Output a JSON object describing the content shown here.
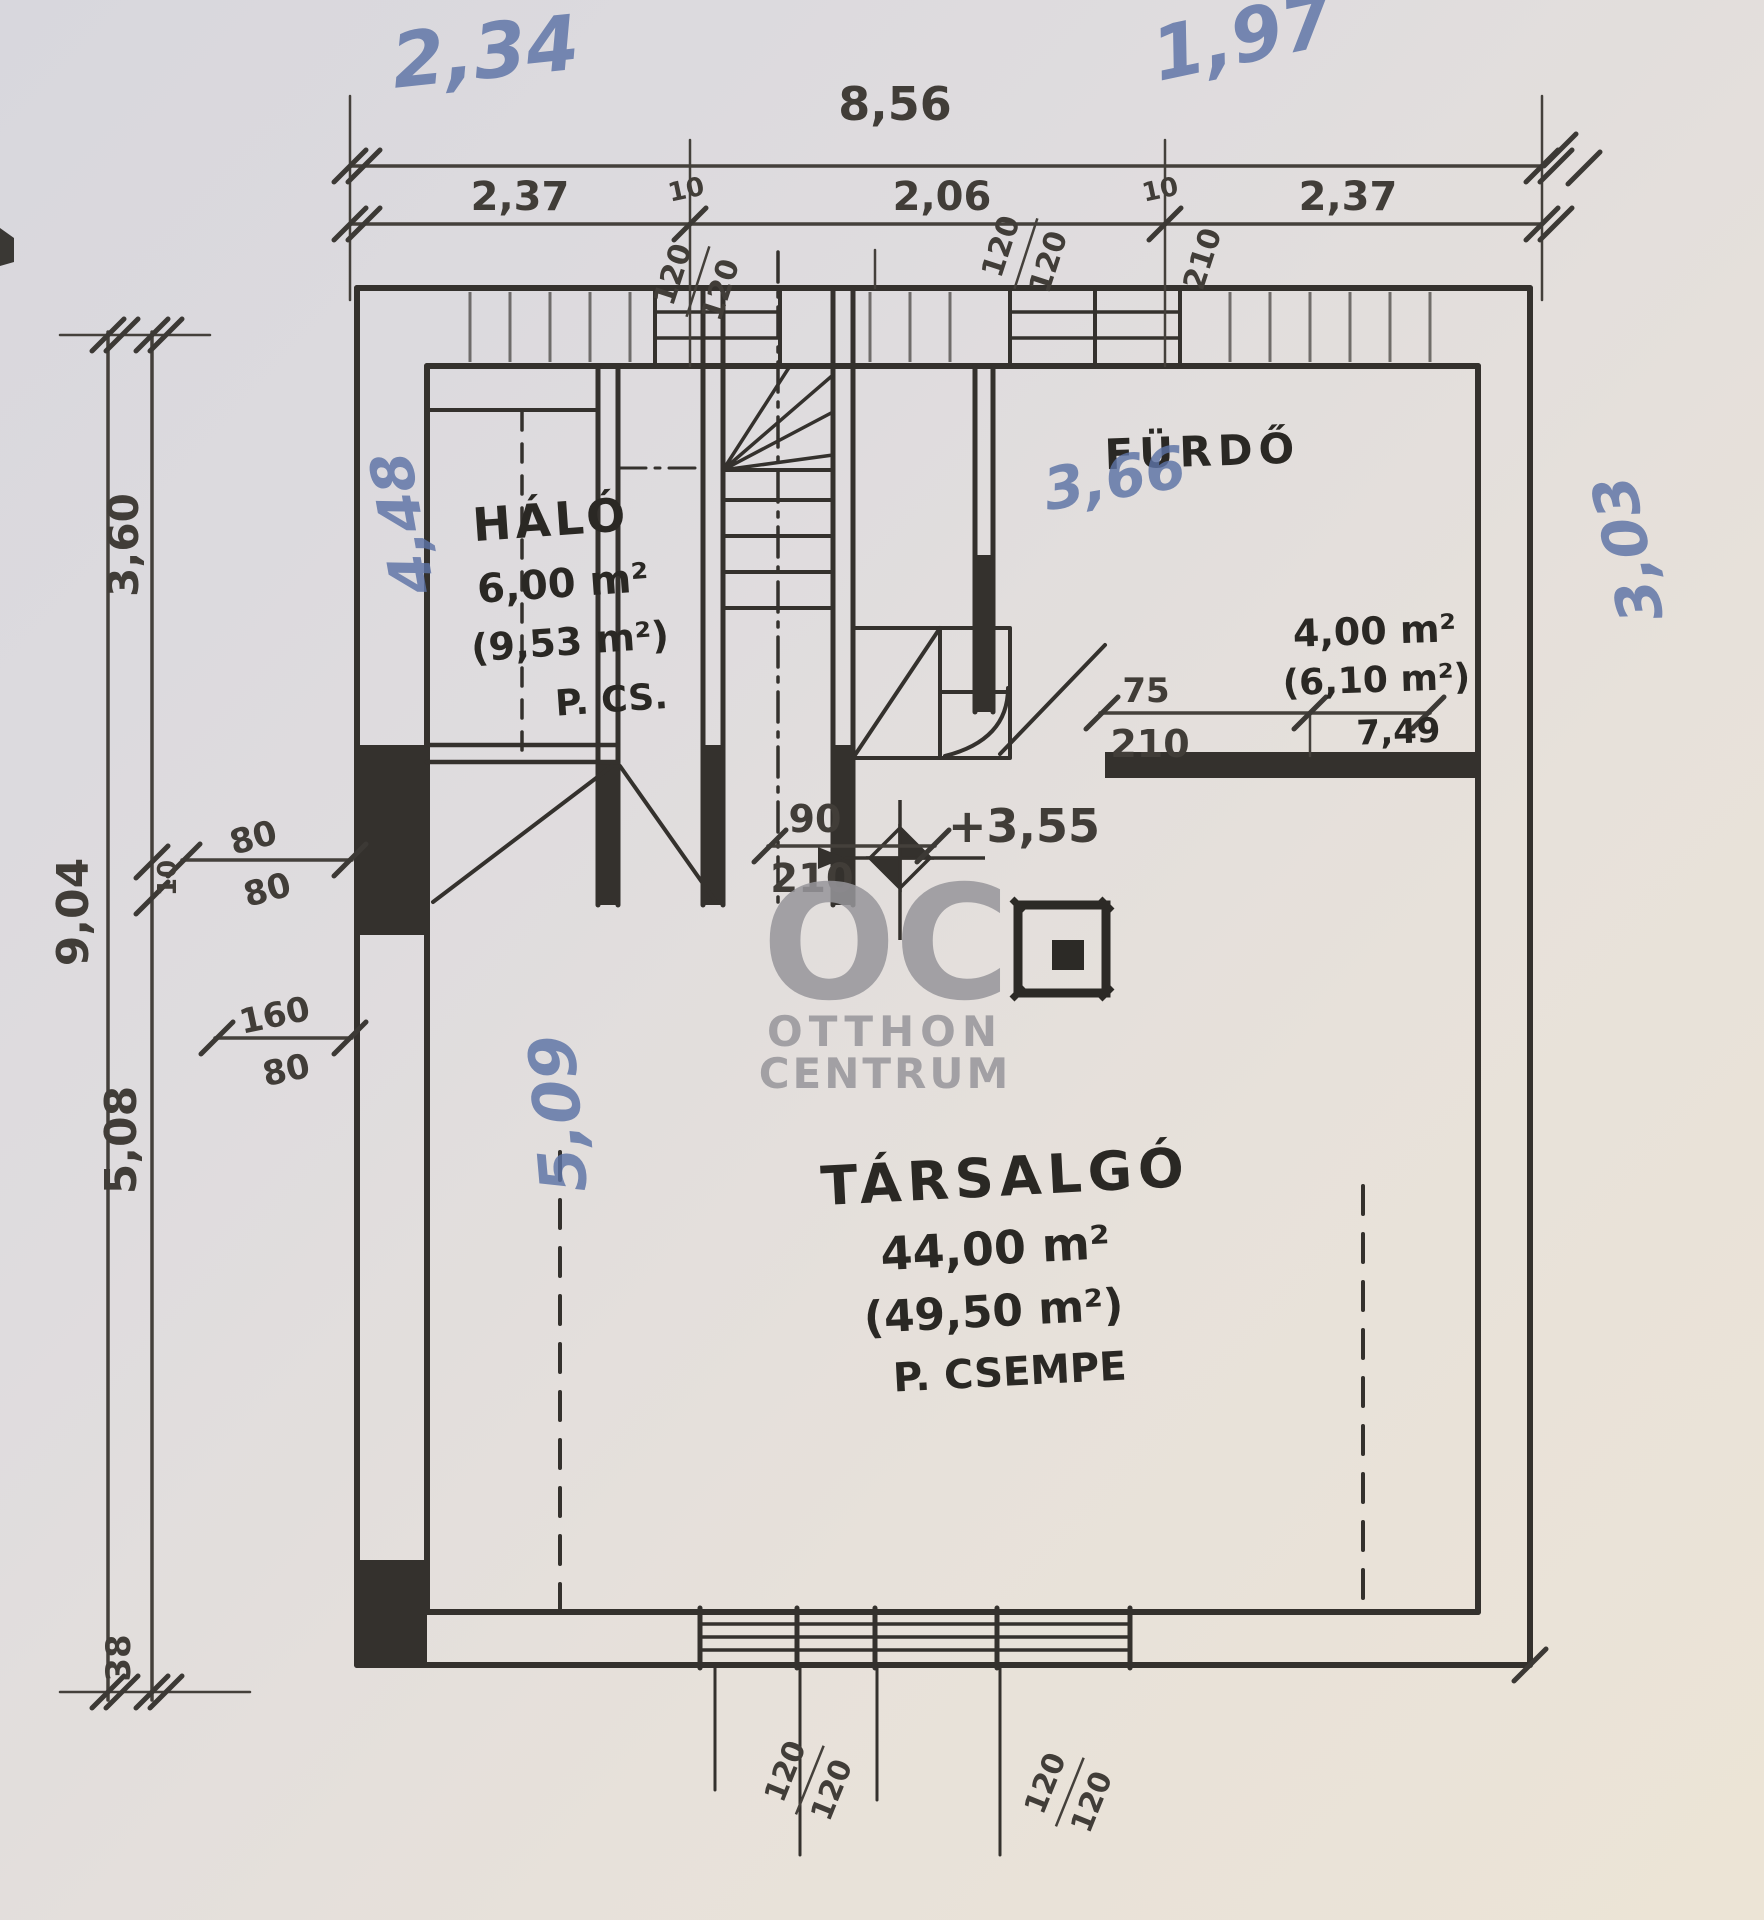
{
  "watermark": {
    "logo": "OC",
    "line1": "OTTHON",
    "line2": "CENTRUM"
  },
  "pen_notes": {
    "top_left": "2,34",
    "top_right": "1,97",
    "stairwell": "3,66",
    "bedroom_side": "4,48",
    "lounge_side": "5,09",
    "right_side": "3,03"
  },
  "top_dims": {
    "total": "8,56",
    "seg_left": "2,37",
    "tick_left": "10",
    "seg_mid": "2,06",
    "tick_right": "10",
    "seg_right": "2,37",
    "win1_a": "120",
    "win1_b": "120",
    "win2_a": "120",
    "win2_b": "120",
    "lintel": "210"
  },
  "left_dims": {
    "total": "9,04",
    "upper": "3,60",
    "wall": "10",
    "lower": "5,08",
    "base": "38",
    "d1_top": "80",
    "d1_bot": "80",
    "d2_top": "160",
    "d2_bot": "80"
  },
  "bottom_dims": {
    "win1_a": "120",
    "win1_b": "120",
    "win2_a": "120",
    "win2_b": "120"
  },
  "doors": {
    "hall_w": "90",
    "hall_h": "210",
    "bath_w": "75",
    "bath_h": "210"
  },
  "level": {
    "value": "+3,55"
  },
  "rooms": {
    "bedroom": {
      "name": "HÁLÓ",
      "area": "6,00 m²",
      "area_gross": "(9,53 m²)",
      "floor": "P. CS."
    },
    "bath": {
      "name": "FÜRDŐ",
      "area": "4,00 m²",
      "area_gross": "(6,10 m²)",
      "note": "7,49"
    },
    "lounge": {
      "name": "TÁRSALGÓ",
      "area": "44,00 m²",
      "area_gross": "(49,50 m²)",
      "floor": "P. CSEMPE"
    }
  }
}
